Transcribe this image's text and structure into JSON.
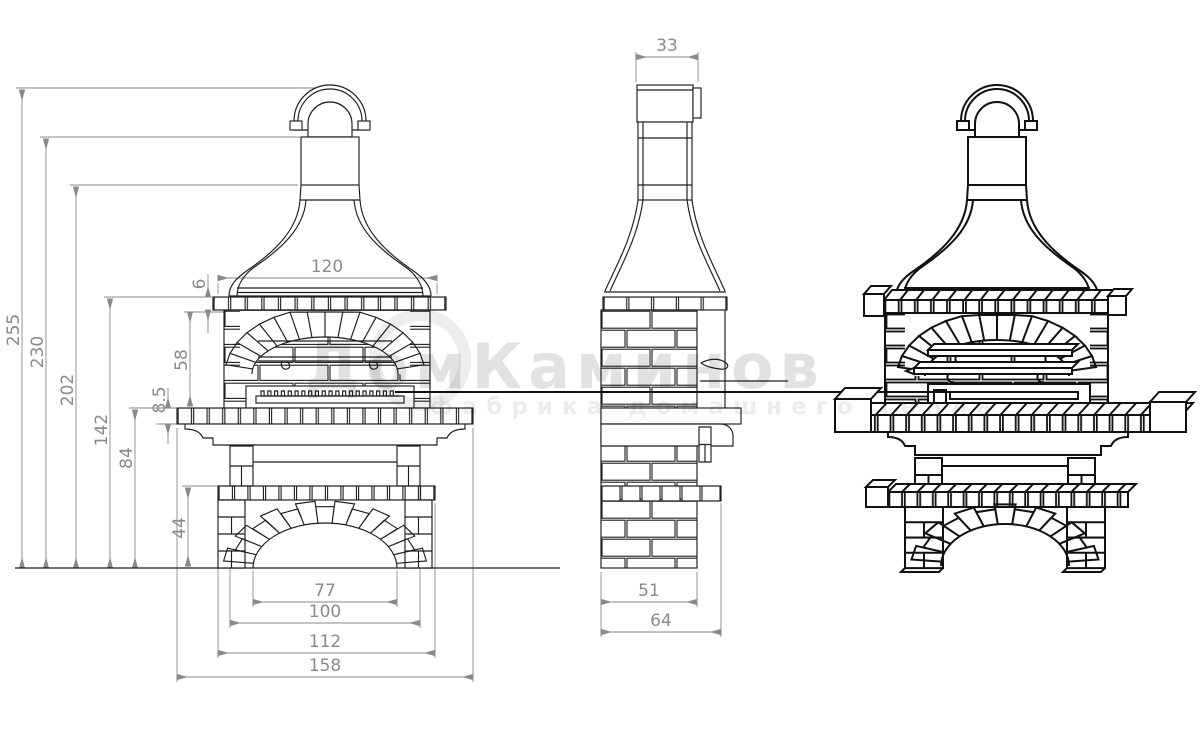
{
  "dims": {
    "front": {
      "total_height": "255",
      "height_to_chimney_base": "230",
      "height_to_hood_top": "202",
      "height_to_mantel": "142",
      "height_to_counter": "84",
      "mantel_row_height": "6",
      "firebox_height": "58",
      "counter_thickness": "8.5",
      "base_section_height": "44",
      "hood_width": "120",
      "arch_opening_width": "77",
      "base_inner_width": "100",
      "base_width": "112",
      "counter_width": "158"
    },
    "side": {
      "chimney_depth": "33",
      "body_depth": "51",
      "base_depth": "64"
    }
  },
  "watermark": {
    "brand": "ДомКаминов",
    "slogan": "фабрика домашнего тепла"
  },
  "colors": {
    "line": "#1d1d1d",
    "dimension": "#8a8a8a",
    "background": "#ffffff"
  }
}
